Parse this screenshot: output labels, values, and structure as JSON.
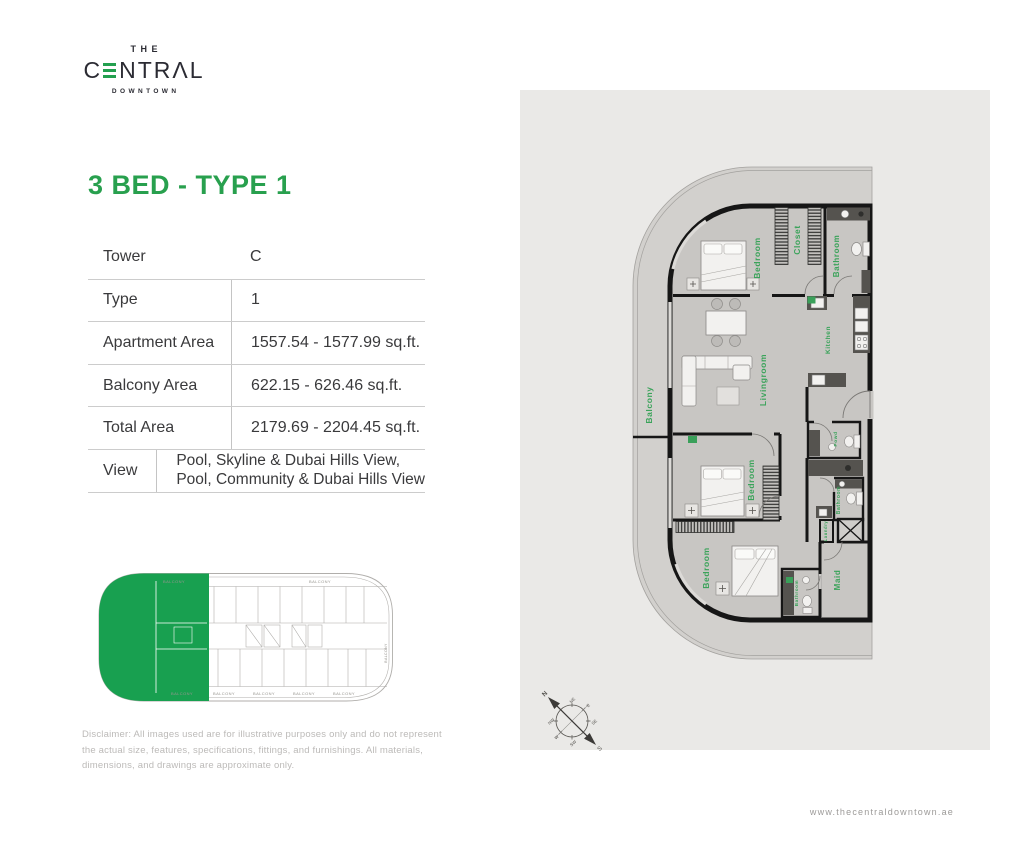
{
  "logo": {
    "top": "THE",
    "name_c": "C",
    "name_rest": "NTRΛL",
    "sub": "DOWNTOWN"
  },
  "heading": {
    "title": "3 BED - TYPE 1"
  },
  "spec_table": {
    "rows": [
      {
        "label": "Tower",
        "value": "C"
      },
      {
        "label": "Type",
        "value": "1"
      },
      {
        "label": "Apartment Area",
        "value": "1557.54 - 1577.99 sq.ft."
      },
      {
        "label": "Balcony Area",
        "value": "622.15 - 626.46 sq.ft."
      },
      {
        "label": "Total Area",
        "value": "2179.69 - 2204.45 sq.ft."
      },
      {
        "label": "View",
        "value": "Pool, Skyline & Dubai Hills View,\nPool, Community & Dubai Hills View"
      }
    ]
  },
  "keyplan": {
    "balcony_label": "BALCONY"
  },
  "floorplan": {
    "labels": {
      "bedroom_top": "Bedroom",
      "closet": "Closet",
      "bathroom_top": "Bathroom",
      "kitchen": "Kitchen",
      "livingroom": "Livingroom",
      "balcony": "Balcony",
      "bedroom_mid": "Bedroom",
      "bathroom_mid": "Bathroom",
      "laundry": "Laundry",
      "powder": "Powd",
      "bedroom_bottom": "Bedroom",
      "maid": "Maid",
      "bathroom_maid": "Bathroom"
    }
  },
  "compass": {
    "points": {
      "n": "N",
      "ne": "NE",
      "e": "E",
      "se": "SE",
      "s": "S",
      "sw": "SW",
      "w": "W",
      "nw": "NW"
    }
  },
  "disclaimer": {
    "text": "Disclaimer: All images used are for illustrative purposes only and do not represent\nthe actual size, features, specifications, fittings, and furnishings. All materials,\ndimensions, and drawings are approximate only."
  },
  "footer": {
    "website": "www.thecentraldowntown.ae"
  },
  "colors": {
    "brand_green": "#28a04e",
    "label_green": "#3aa35a",
    "keyplan_green": "#18a050",
    "logo_dark": "#2b2b33",
    "panel_bg": "#eae9e7"
  }
}
